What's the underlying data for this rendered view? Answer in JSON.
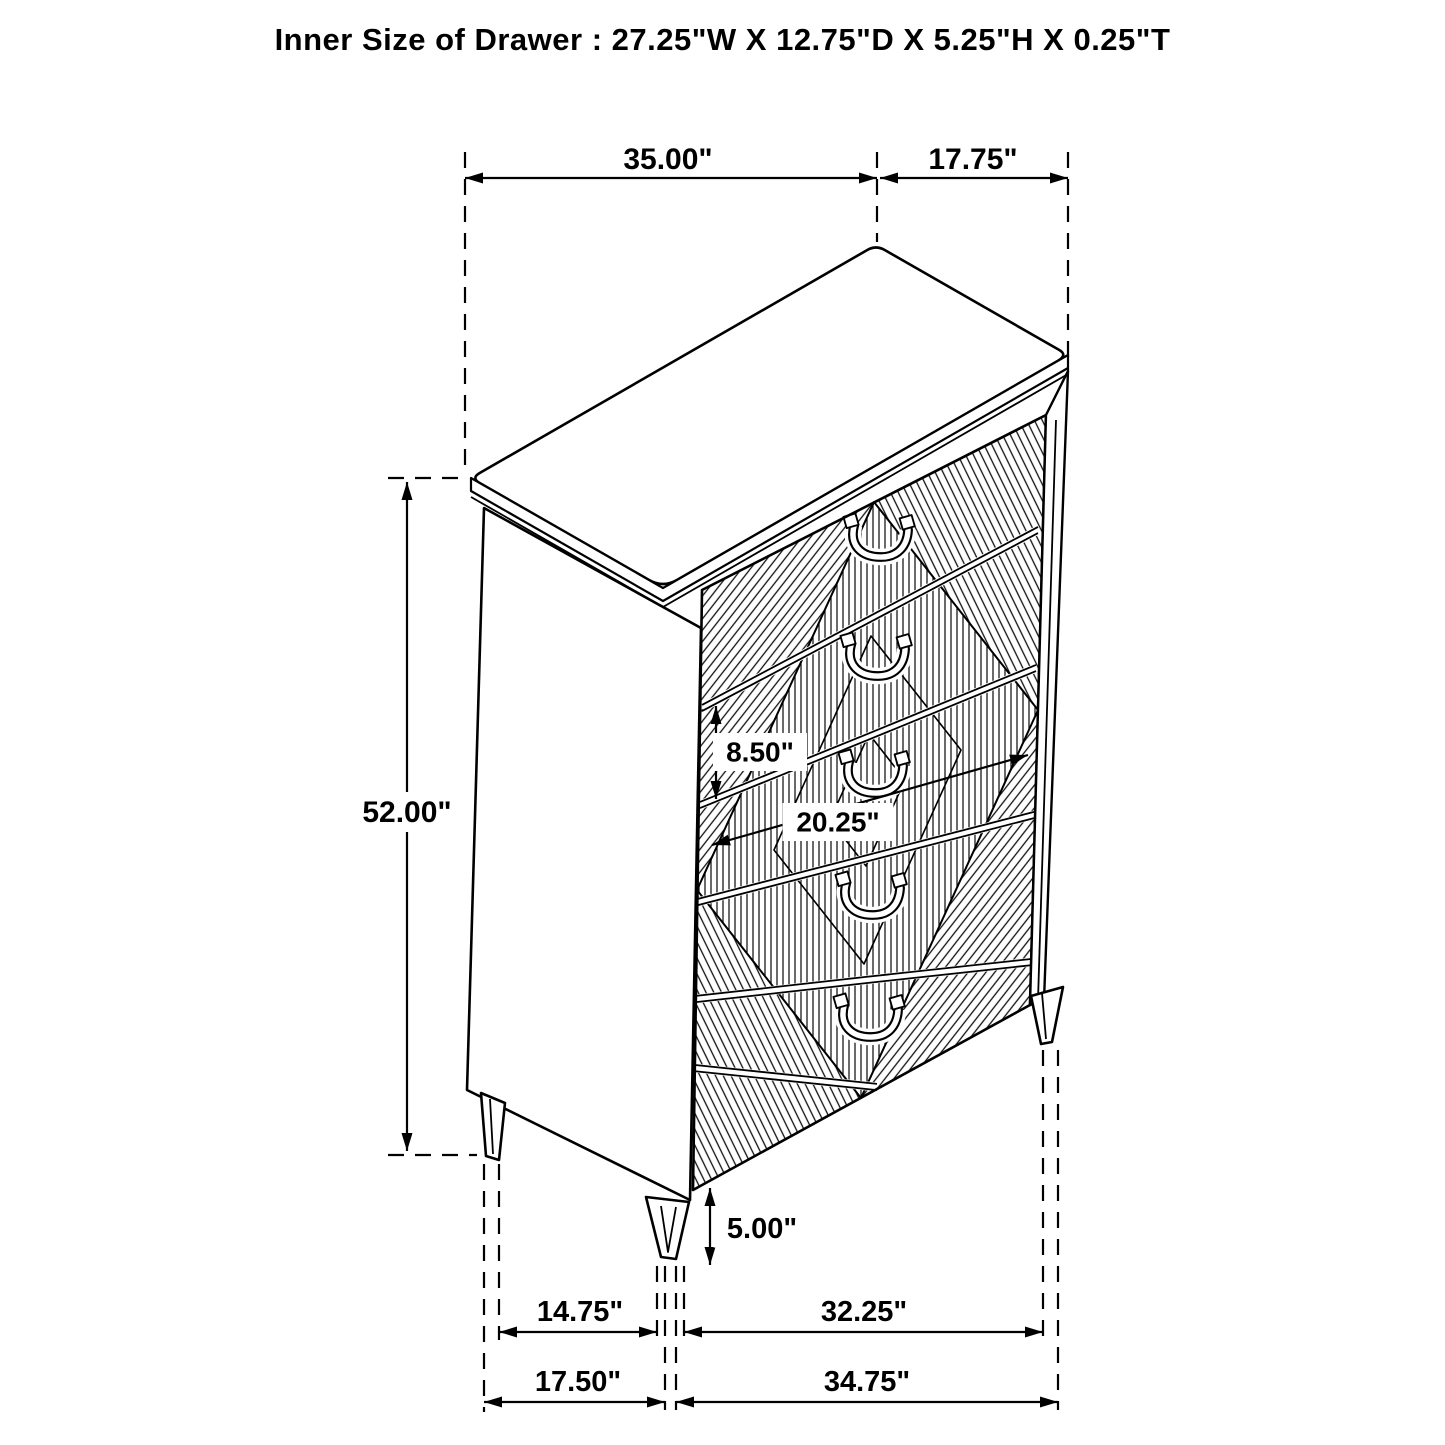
{
  "title": "Inner Size of Drawer : 27.25\"W X 12.75\"D X 5.25\"H X 0.25\"T",
  "diagram": {
    "type": "furniture-dimension-diagram",
    "item": "chest-of-drawers",
    "drawer_count": 5,
    "colors": {
      "line": "#000000",
      "background": "#ffffff"
    },
    "inner_drawer": {
      "width": "27.25\"",
      "depth": "12.75\"",
      "height": "5.25\"",
      "thickness": "0.25\""
    },
    "dimensions": [
      {
        "id": "top-width",
        "label": "35.00\""
      },
      {
        "id": "top-depth",
        "label": "17.75\""
      },
      {
        "id": "height",
        "label": "52.00\""
      },
      {
        "id": "drawer-height",
        "label": "8.50\""
      },
      {
        "id": "drawer-width",
        "label": "20.25\""
      },
      {
        "id": "leg-height",
        "label": "5.00\""
      },
      {
        "id": "base-depth-inner",
        "label": "14.75\""
      },
      {
        "id": "base-width-inner",
        "label": "32.25\""
      },
      {
        "id": "base-depth",
        "label": "17.50\""
      },
      {
        "id": "base-width",
        "label": "34.75\""
      }
    ]
  }
}
